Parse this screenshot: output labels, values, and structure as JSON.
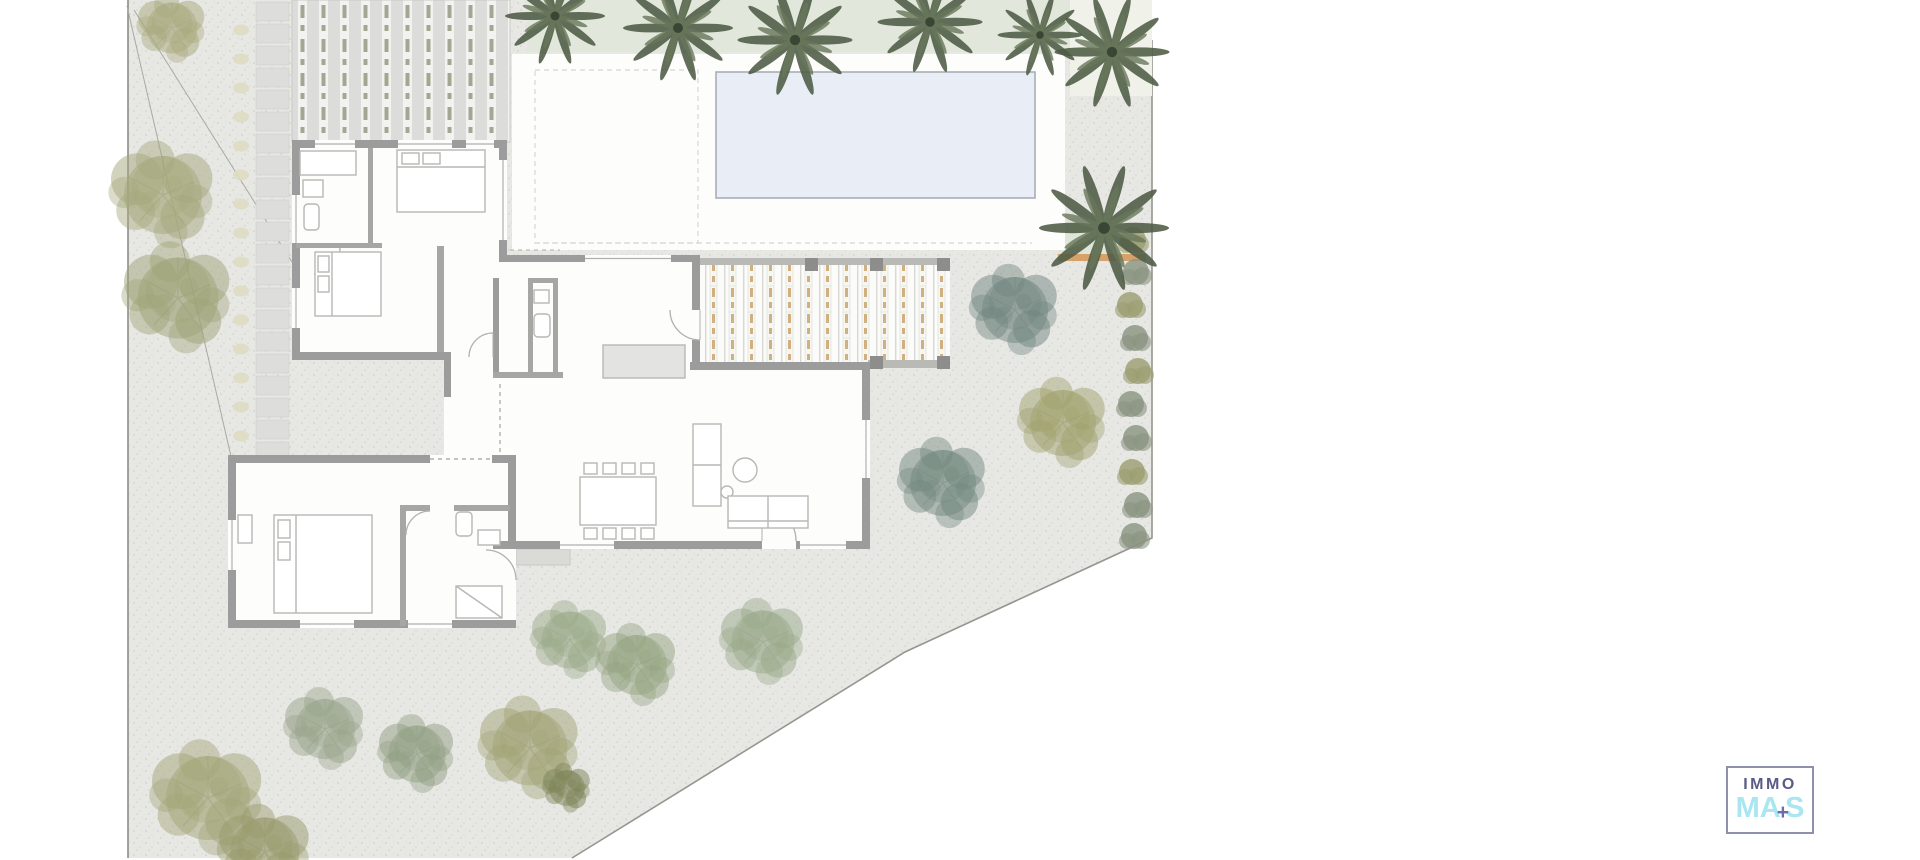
{
  "logo": {
    "line1": "IMMO",
    "line2_prefix": "MA",
    "plus": "+",
    "line2_suffix": "S",
    "colors": {
      "line1": "#5a5b87",
      "line2": "#a8e6f2",
      "plus": "#6b6ca8",
      "border": "#8f90ae"
    }
  },
  "palette": {
    "gravel": "#e7e7e4",
    "terrace": "#fdfdfc",
    "pool_fill": "#e9edf6",
    "pool_border": "#a9aeb6",
    "hedge": "#e2e7dc",
    "garden_strip": "#f0f2ea",
    "fence_accent": "#d7a169",
    "wall": "#9b9c9b",
    "interior_wall": "#a6a7a5",
    "furniture_line": "#b7b7b4",
    "pergola_gray": "#dcdcda",
    "pergola_tan": "#c9a46b",
    "palm_green": "#4e5c45",
    "olive_tree": "#a3a577",
    "sage_tree": "#9aa58b",
    "teal_tree": "#71867f",
    "boundary_line": "#96968f"
  },
  "scene": {
    "palms": [
      {
        "x": 555,
        "y": 16,
        "s": 1.0
      },
      {
        "x": 678,
        "y": 28,
        "s": 1.1
      },
      {
        "x": 795,
        "y": 40,
        "s": 1.15
      },
      {
        "x": 930,
        "y": 22,
        "s": 1.05
      },
      {
        "x": 1040,
        "y": 35,
        "s": 0.85
      },
      {
        "x": 1112,
        "y": 52,
        "s": 1.15
      },
      {
        "x": 1104,
        "y": 228,
        "s": 1.3
      }
    ],
    "trees": [
      {
        "x": 172,
        "y": 28,
        "s": 0.85,
        "c": "#a9aa7e"
      },
      {
        "x": 163,
        "y": 195,
        "s": 1.3,
        "c": "#a5a87c"
      },
      {
        "x": 178,
        "y": 298,
        "s": 1.35,
        "c": "#9fa478"
      },
      {
        "x": 208,
        "y": 798,
        "s": 1.4,
        "c": "#a3a577"
      },
      {
        "x": 265,
        "y": 852,
        "s": 1.15,
        "c": "#989a6b"
      },
      {
        "x": 325,
        "y": 729,
        "s": 1.0,
        "c": "#9aa58b"
      },
      {
        "x": 417,
        "y": 754,
        "s": 0.95,
        "c": "#91a083"
      },
      {
        "x": 530,
        "y": 748,
        "s": 1.25,
        "c": "#a2a476"
      },
      {
        "x": 567,
        "y": 788,
        "s": 0.6,
        "c": "#7e8457"
      },
      {
        "x": 570,
        "y": 640,
        "s": 0.95,
        "c": "#9cab8a"
      },
      {
        "x": 637,
        "y": 665,
        "s": 1.0,
        "c": "#95a582"
      },
      {
        "x": 763,
        "y": 642,
        "s": 1.05,
        "c": "#9aa98a"
      },
      {
        "x": 1015,
        "y": 310,
        "s": 1.1,
        "c": "#71867f"
      },
      {
        "x": 943,
        "y": 483,
        "s": 1.1,
        "c": "#74897f"
      },
      {
        "x": 1063,
        "y": 423,
        "s": 1.1,
        "c": "#a1a26e"
      }
    ],
    "bushes": [
      {
        "x": 1133,
        "y": 240,
        "c": "#9b9d70"
      },
      {
        "x": 1136,
        "y": 272,
        "c": "#8a9480"
      },
      {
        "x": 1130,
        "y": 305,
        "c": "#9b9d70"
      },
      {
        "x": 1135,
        "y": 338,
        "c": "#8a9480"
      },
      {
        "x": 1138,
        "y": 371,
        "c": "#9b9d70"
      },
      {
        "x": 1131,
        "y": 404,
        "c": "#8a9480"
      },
      {
        "x": 1136,
        "y": 438,
        "c": "#8a9480"
      },
      {
        "x": 1132,
        "y": 472,
        "c": "#9b9d70"
      },
      {
        "x": 1137,
        "y": 505,
        "c": "#8a9480"
      },
      {
        "x": 1134,
        "y": 536,
        "c": "#8a9480"
      }
    ],
    "driveway_slabs": {
      "x": 256,
      "width": 33,
      "y_start": 2,
      "height": 19,
      "gap": 3,
      "count": 21,
      "fill": "#dddddb",
      "stroke": "#cfcfcb"
    },
    "stepping_stones": {
      "x": 241,
      "y_start": 30,
      "step": 29,
      "count": 15,
      "rx": 8,
      "ry": 5.5,
      "fill": "#dedcc2"
    }
  }
}
